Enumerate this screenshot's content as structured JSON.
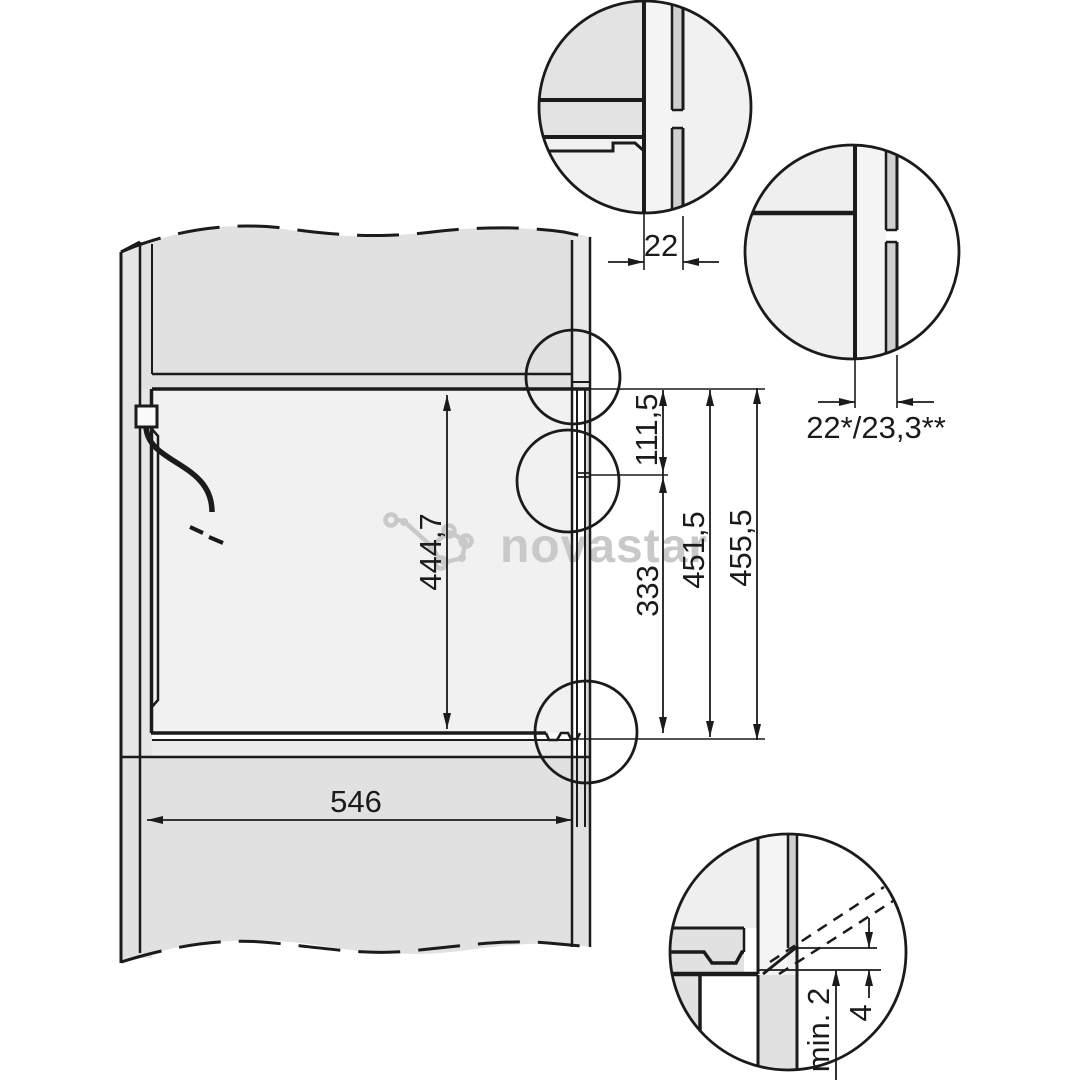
{
  "diagram": {
    "type": "appliance-niche-installation-drawing",
    "labels": {
      "niche_height": "444,7",
      "top_offset": "111,5",
      "mid_span": "333",
      "front_height_inner": "451,5",
      "front_height_outer": "455,5",
      "depth": "546",
      "front_thickness_top": "22",
      "front_thickness_side": "22*/23,3**",
      "bottom_clearance": "min. 2",
      "bottom_gap": "4"
    }
  },
  "watermark": {
    "text": "novastar",
    "color": "#c9c9c9"
  },
  "colors": {
    "line": "#1b1b1b",
    "cabinet_fill": "#e1e1e1",
    "niche_fill": "#f1f1f1",
    "panel_fill": "#cfcfcf",
    "background": "#ffffff"
  }
}
